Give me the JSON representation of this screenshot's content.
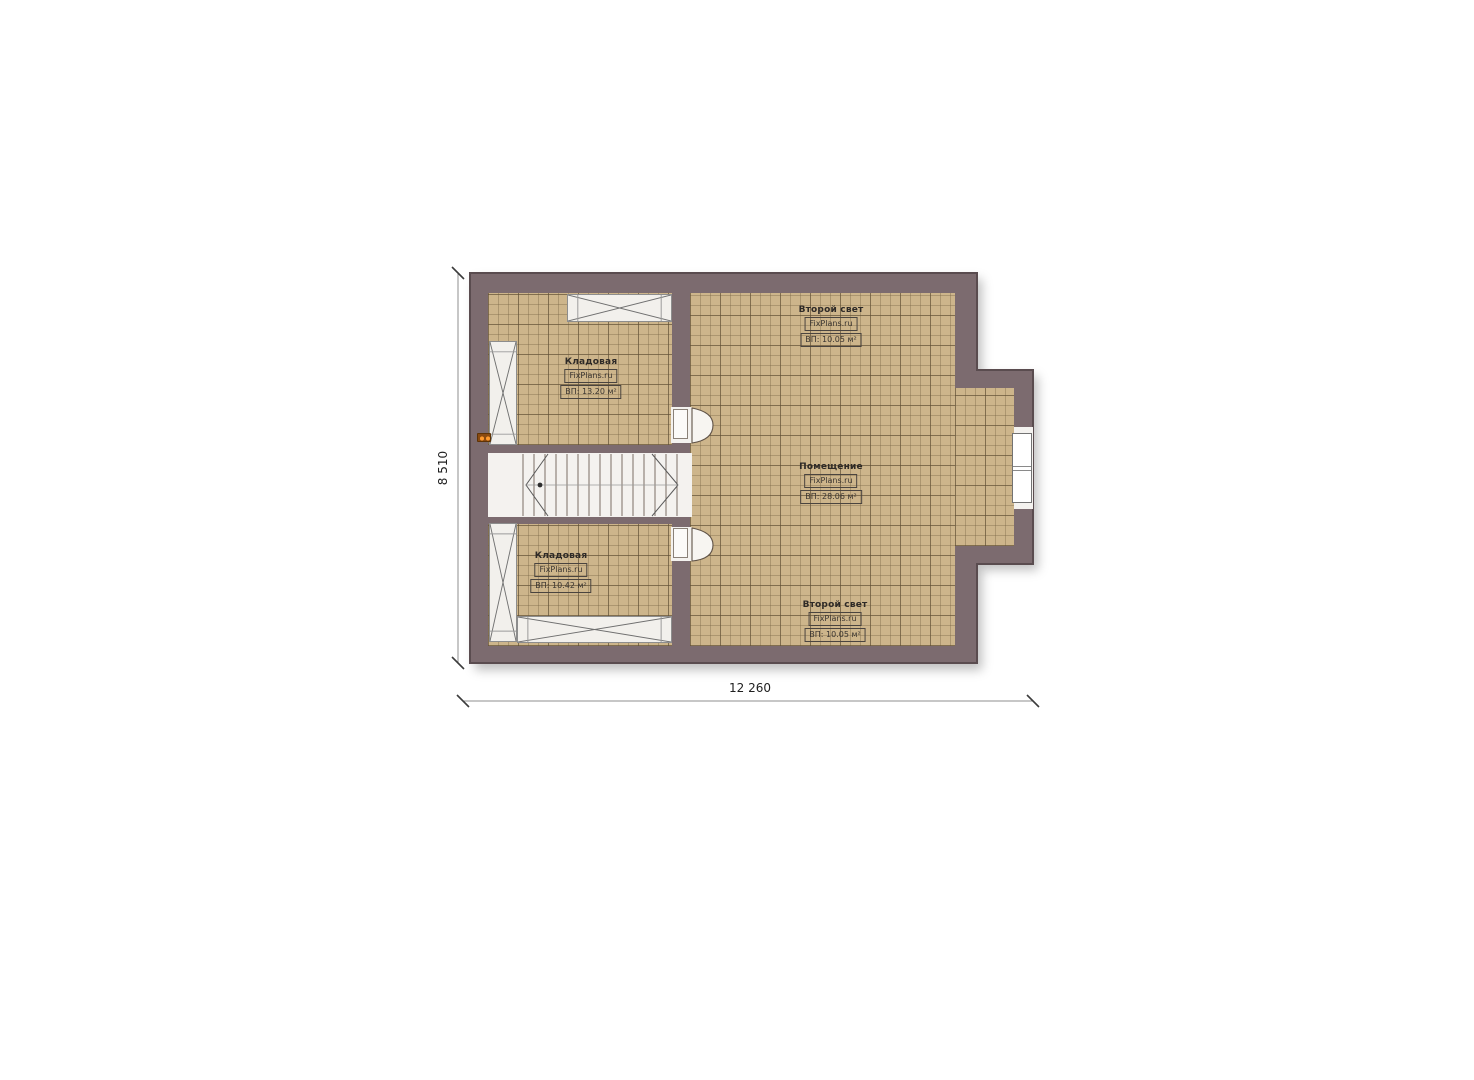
{
  "plan": {
    "type": "attic floor plan",
    "rooms": {
      "storage_top": {
        "name": "Кладовая",
        "brand": "FixPlans.ru",
        "area": "ВП: 13.20 м²"
      },
      "second_light_top": {
        "name": "Второй свет",
        "brand": "FixPlans.ru",
        "area": "ВП: 10.05 м²"
      },
      "main_room": {
        "name": "Помещение",
        "brand": "FixPlans.ru",
        "area": "ВП: 28.06 м²"
      },
      "storage_bottom": {
        "name": "Кладовая",
        "brand": "FixPlans.ru",
        "area": "ВП: 10.42 м²"
      },
      "second_light_bottom": {
        "name": "Второй свет",
        "brand": "FixPlans.ru",
        "area": "ВП: 10.05 м²"
      }
    },
    "dimensions": {
      "horizontal": "12 260",
      "vertical": "8 510"
    },
    "colors": {
      "wall": "#7c6b6f",
      "wall_outline": "#5a4c4f",
      "floor_tile": "#cdb58b",
      "tile_grid_minor": "#7b6746",
      "tile_grid_major": "#5e4e34",
      "opening_white": "#f4f2ef",
      "accent_marker": "#e0751a",
      "dimension_line": "#8f8f8f",
      "text": "#2e2a27",
      "background": "#ffffff"
    }
  }
}
